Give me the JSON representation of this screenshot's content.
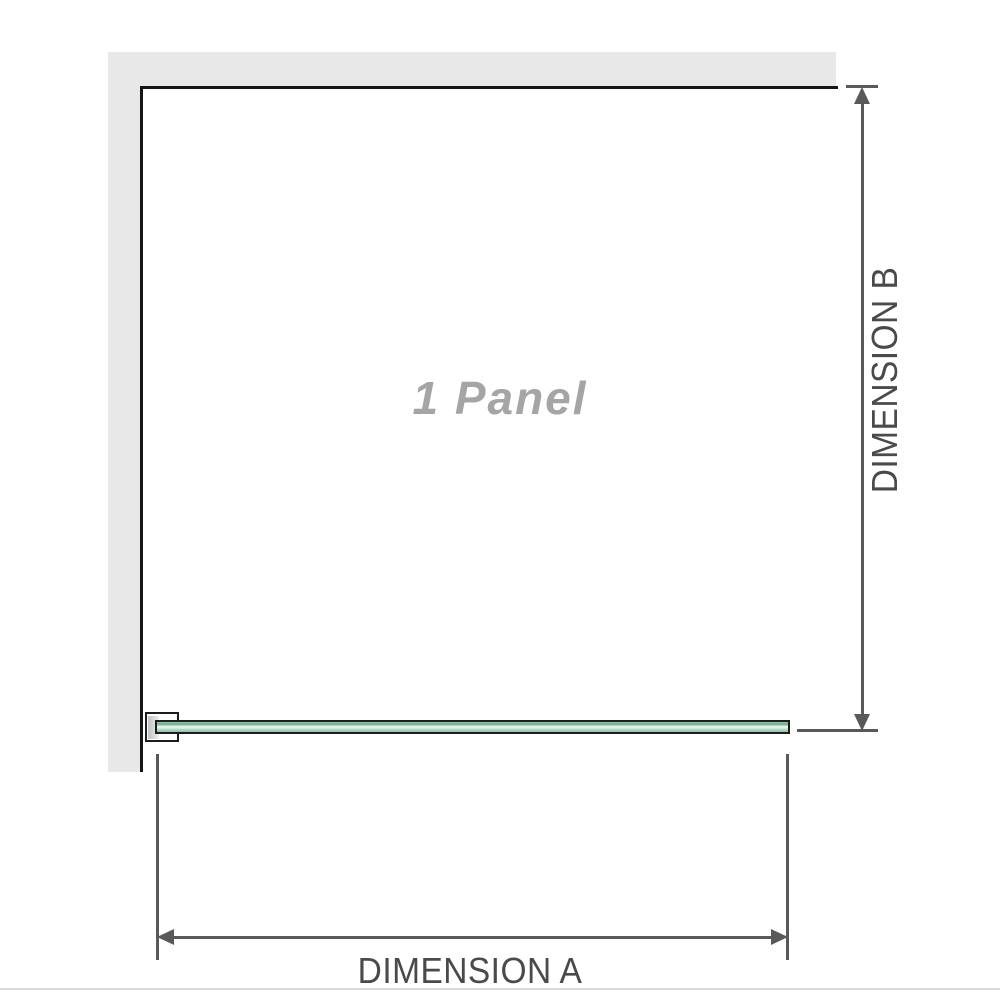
{
  "diagram": {
    "panel_label": "1 Panel",
    "dimension_a": {
      "label": "DIMENSION A",
      "orientation": "horizontal"
    },
    "dimension_b": {
      "label": "DIMENSION B",
      "orientation": "vertical"
    },
    "icons": {
      "arrow_up": "triangle-up",
      "arrow_down": "triangle-down",
      "arrow_left": "triangle-left",
      "arrow_right": "triangle-right"
    },
    "colors": {
      "wall": "#e8e8e8",
      "panel_outline": "#151515",
      "glass_outline": "#1c1c1c",
      "glass_green_mid": "#96cfae",
      "glass_green_dark": "#6aa886",
      "glass_green_light": "#e9f6ee",
      "dimension_lines": "#58595b",
      "dimension_text": "#4a4a4a",
      "panel_text": "#a5a5a5",
      "separator": "#dbdbd5"
    }
  }
}
